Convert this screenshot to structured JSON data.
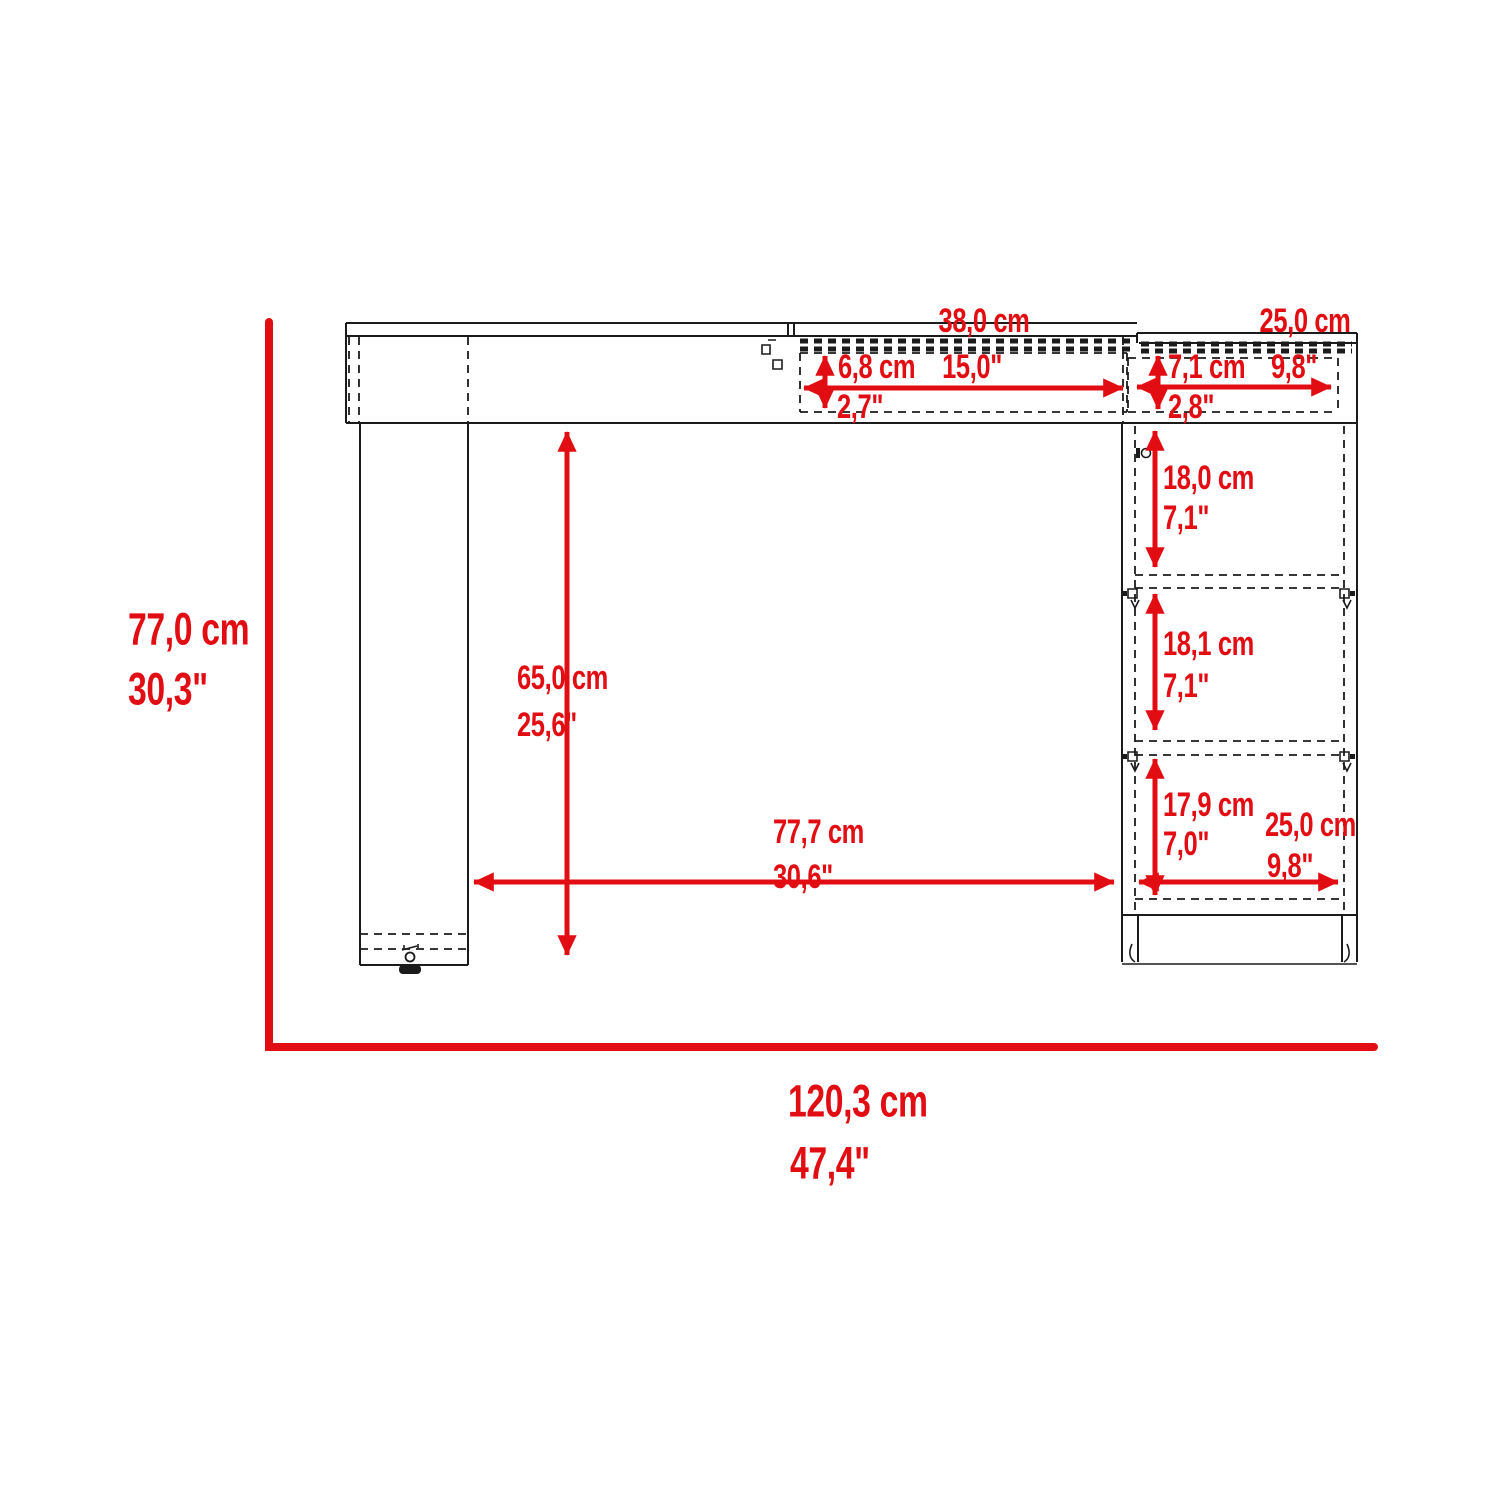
{
  "diagram": {
    "type": "furniture-dimension-drawing",
    "subject": "computer desk with top drawers, left leg panel and right storage cabinet",
    "units": [
      "cm",
      "inches"
    ],
    "accent_color": "#e20d12",
    "line_color": "#1b1b1b",
    "background_color": "#ffffff"
  },
  "dims": {
    "overall_height": {
      "cm": "77,0 cm",
      "in": "30,3\""
    },
    "overall_width": {
      "cm": "120,3 cm",
      "in": "47,4\""
    },
    "mid_drawer_width": {
      "cm": "38,0 cm",
      "in": "15,0\""
    },
    "mid_drawer_height": {
      "cm": "6,8 cm",
      "in": "2,7\""
    },
    "right_drawer_width": {
      "cm": "25,0 cm",
      "in": "9,8\""
    },
    "right_drawer_height": {
      "cm": "7,1 cm",
      "in": "2,8\""
    },
    "cabinet_shelf_top": {
      "cm": "18,0 cm",
      "in": "7,1\""
    },
    "cabinet_shelf_middle": {
      "cm": "18,1 cm",
      "in": "7,1\""
    },
    "cabinet_shelf_bottom": {
      "cm": "17,9 cm",
      "in": "7,0\""
    },
    "cabinet_width": {
      "cm": "25,0 cm",
      "in": "9,8\""
    },
    "knee_space_height": {
      "cm": "65,0 cm",
      "in": "25,6\""
    },
    "knee_space_width": {
      "cm": "77,7 cm",
      "in": "30,6\""
    }
  }
}
